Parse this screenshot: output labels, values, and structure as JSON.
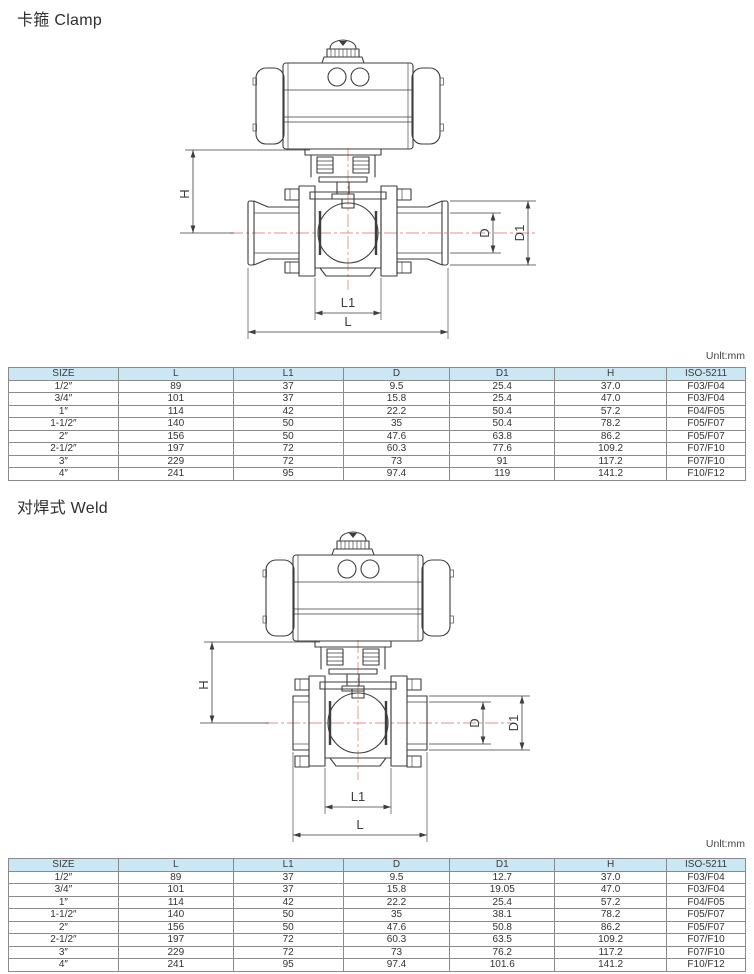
{
  "colors": {
    "table_header_bg": "#cbe7f4",
    "drawing_line": "#3d3d3d",
    "centerline_red": "#e58e8e",
    "page_bg": "#ffffff"
  },
  "sections": [
    {
      "id": "clamp",
      "title": "卡箍 Clamp",
      "unit_label": "Unlt:mm",
      "diagram": {
        "name": "pneumatic-actuated-ball-valve-clamp-end",
        "dimension_labels": {
          "H": "H",
          "D": "D",
          "D1": "D1",
          "L1": "L1",
          "L": "L"
        }
      },
      "table": {
        "columns": [
          "SIZE",
          "L",
          "L1",
          "D",
          "D1",
          "H",
          "ISO-5211"
        ],
        "rows": [
          [
            "1/2″",
            "89",
            "37",
            "9.5",
            "25.4",
            "37.0",
            "F03/F04"
          ],
          [
            "3/4″",
            "101",
            "37",
            "15.8",
            "25.4",
            "47.0",
            "F03/F04"
          ],
          [
            "1″",
            "114",
            "42",
            "22.2",
            "50.4",
            "57.2",
            "F04/F05"
          ],
          [
            "1-1/2″",
            "140",
            "50",
            "35",
            "50.4",
            "78.2",
            "F05/F07"
          ],
          [
            "2″",
            "156",
            "50",
            "47.6",
            "63.8",
            "86.2",
            "F05/F07"
          ],
          [
            "2-1/2″",
            "197",
            "72",
            "60.3",
            "77.6",
            "109.2",
            "F07/F10"
          ],
          [
            "3″",
            "229",
            "72",
            "73",
            "91",
            "117.2",
            "F07/F10"
          ],
          [
            "4″",
            "241",
            "95",
            "97.4",
            "119",
            "141.2",
            "F10/F12"
          ]
        ]
      }
    },
    {
      "id": "weld",
      "title": "对焊式 Weld",
      "unit_label": "Unlt:mm",
      "diagram": {
        "name": "pneumatic-actuated-ball-valve-weld-end",
        "dimension_labels": {
          "H": "H",
          "D": "D",
          "D1": "D1",
          "L1": "L1",
          "L": "L"
        }
      },
      "table": {
        "columns": [
          "SIZE",
          "L",
          "L1",
          "D",
          "D1",
          "H",
          "ISO-5211"
        ],
        "rows": [
          [
            "1/2″",
            "89",
            "37",
            "9.5",
            "12.7",
            "37.0",
            "F03/F04"
          ],
          [
            "3/4″",
            "101",
            "37",
            "15.8",
            "19.05",
            "47.0",
            "F03/F04"
          ],
          [
            "1″",
            "114",
            "42",
            "22.2",
            "25.4",
            "57.2",
            "F04/F05"
          ],
          [
            "1-1/2″",
            "140",
            "50",
            "35",
            "38.1",
            "78.2",
            "F05/F07"
          ],
          [
            "2″",
            "156",
            "50",
            "47.6",
            "50.8",
            "86.2",
            "F05/F07"
          ],
          [
            "2-1/2″",
            "197",
            "72",
            "60.3",
            "63.5",
            "109.2",
            "F07/F10"
          ],
          [
            "3″",
            "229",
            "72",
            "73",
            "76.2",
            "117.2",
            "F07/F10"
          ],
          [
            "4″",
            "241",
            "95",
            "97.4",
            "101.6",
            "141.2",
            "F10/F12"
          ]
        ]
      }
    }
  ]
}
